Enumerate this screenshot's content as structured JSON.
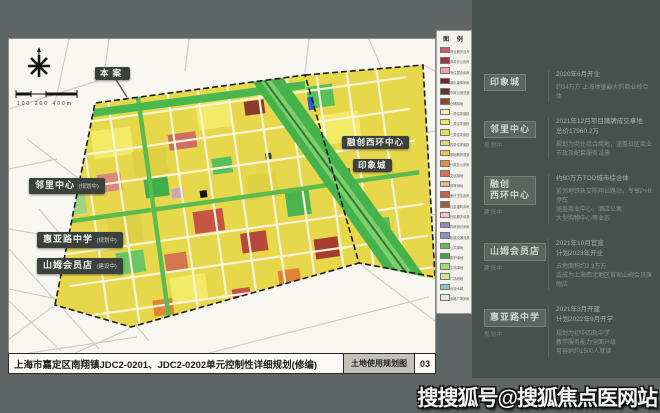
{
  "map": {
    "title_bar": {
      "title": "上海市嘉定区南翔镇JDC2-0201、JDC2-0202单元控制性详细规划(修编)",
      "sheet_name": "土地使用规划图",
      "sheet_no": "03"
    },
    "scale_label": "100  200    400m",
    "labels": {
      "benan": "本案",
      "linli": {
        "name": "邻里中心",
        "status": "(规划中)"
      },
      "huiya": {
        "name": "惠亚路中学",
        "status": "(规划中)"
      },
      "sams": {
        "name": "山姆会员店",
        "status": "(建设中)"
      },
      "sunac": "融创西环中心",
      "yinxiang": "印象城"
    }
  },
  "legend": {
    "title": "图 例",
    "items": [
      {
        "color": "#d05a70",
        "label": "商业服务业用地"
      },
      {
        "color": "#a13248",
        "label": "商务办公用地"
      },
      {
        "color": "#e8a2b0",
        "label": "商住混合用地"
      },
      {
        "color": "#6e2738",
        "label": "娱乐康体用地"
      },
      {
        "color": "#5c3a28",
        "label": "市政公用设施用地"
      },
      {
        "color": "#8c4636",
        "label": "仓储用地"
      },
      {
        "color": "#f6f2b2",
        "label": "一类住宅组团用地"
      },
      {
        "color": "#f1e964",
        "label": "二类住宅组团用地"
      },
      {
        "color": "#e8df4e",
        "label": "三类住宅组团用地"
      },
      {
        "color": "#d9da78",
        "label": "四类住宅组团用地"
      },
      {
        "color": "#e3c44c",
        "label": "基础教育设施用地"
      },
      {
        "color": "#df8f3e",
        "label": "行政办公用地"
      },
      {
        "color": "#d4704e",
        "label": "文化用地"
      },
      {
        "color": "#e7b29c",
        "label": "体育用地"
      },
      {
        "color": "#c2614e",
        "label": "医疗卫生用地"
      },
      {
        "color": "#a85a40",
        "label": "社会福利用地"
      },
      {
        "color": "#f0c2cc",
        "label": "社区服务设施用地"
      },
      {
        "color": "#9787b9",
        "label": "科研设计用地"
      },
      {
        "color": "#8495c6",
        "label": "轨道交通设施用地"
      },
      {
        "color": "#6db45e",
        "label": "公共绿地"
      },
      {
        "color": "#41a24c",
        "label": "防护绿地"
      },
      {
        "color": "#a6d676",
        "label": "生态绿地"
      },
      {
        "color": "#cbe89a",
        "label": "广场用地"
      },
      {
        "color": "#8cc5bb",
        "label": "河流水域"
      },
      {
        "color": "#e6e6e2",
        "label": "道路广场用地"
      }
    ]
  },
  "panel": {
    "sections": [
      {
        "name": "印象城",
        "status": "",
        "facts": [
          "2020年6月开业"
        ],
        "details": [
          "约34万方 上海体量最大的商业综合体"
        ]
      },
      {
        "name": "邻里中心",
        "status": "规划中",
        "facts": [
          "2021年12月项目摘牌成交拿地",
          "总价17960.2万"
        ],
        "details": [
          "规划为商住综合用地，涵盖社区商业",
          "市政及配套服务设施"
        ]
      },
      {
        "name": "融创\n西环中心",
        "status": "建设中",
        "facts": [
          "约60万方TOD城市综合体"
        ],
        "details": [
          "紧邻地铁轨交陈翔公路站，专享P+R停车",
          "涵盖商业中心、酒店公寓",
          "大型购物中心等业态"
        ]
      },
      {
        "name": "山姆会员店",
        "status": "建设中",
        "facts": [
          "2021年10月官宣",
          "计划2023年开业"
        ],
        "details": [
          "占地面积约2.3万方",
          "或成为上海西北地区首家山姆会员旗舰店"
        ]
      },
      {
        "name": "惠亚路中学",
        "status": "规划中",
        "facts": [
          "2021年3月开建",
          "计划2022年9月开学"
        ],
        "details": [
          "规划为初中四轨中学",
          "教学服务能力全面升级",
          "可容纳约1500人就读"
        ]
      }
    ]
  },
  "watermark": "搜搜狐号@搜狐焦点医网站"
}
